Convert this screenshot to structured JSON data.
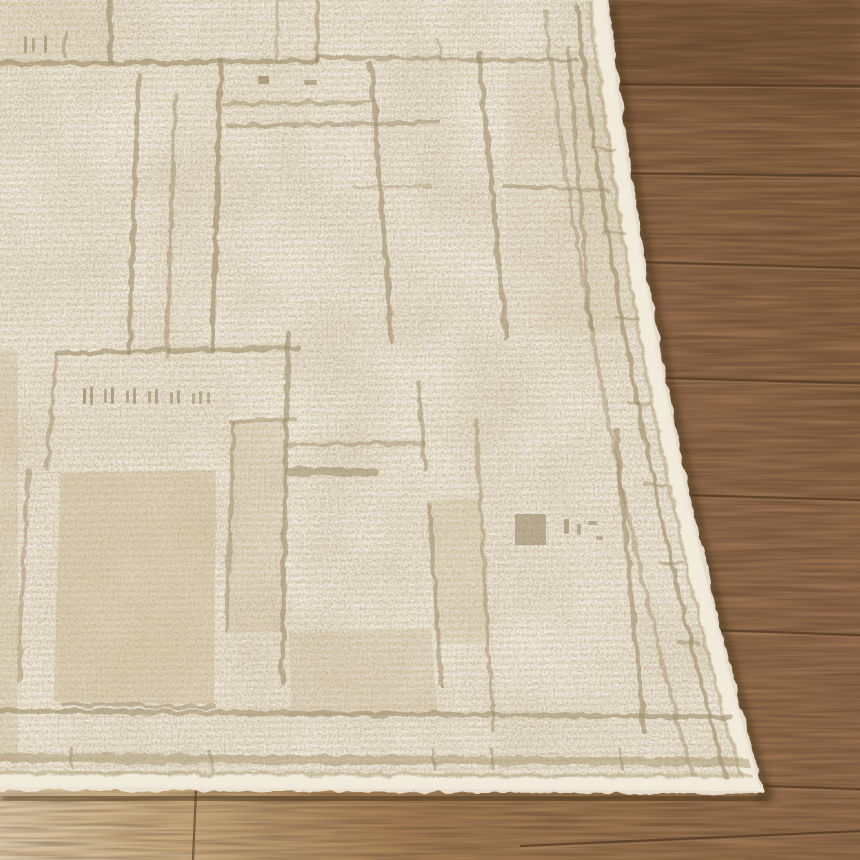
{
  "scene": {
    "description": "Close-up photo of the corner of a cream textured area rug with an abstract tan geometric grid pattern, laid diagonally on a warm oak wood plank floor",
    "rug_style": "cream bouclé pile, tonal taupe line patchwork pattern, plain cream binding edge",
    "floor_style": "oak planks, horizontal seams, pale sunlit strip at bottom-left"
  },
  "palette": {
    "rug_base": "#eae2d0",
    "rug_highlight": "#f6f1e4",
    "rug_row_shadow": "#d8ccb2",
    "line": "#9b8862",
    "line_dark": "#8d7a55",
    "block": "#c2ae87",
    "binding": "#f2ecdd",
    "groove": "#b3a37e",
    "stripe": "#a7936c",
    "wood_dark": "#7d5a3d",
    "wood_mid": "#8d6a48",
    "wood_light": "#a9835a",
    "floor_pale": "#e0cfb2",
    "seam": "#553c26",
    "seam_light": "#bb9368",
    "shadow": "#443019"
  },
  "render": {
    "rug": {
      "outline_path": "M0,0 L606,0 Q652,405 761,791 L0,787 Z",
      "corner": {
        "x": 761,
        "y": 791
      },
      "field_lines": [
        [
          0,
          64,
          318,
          61,
          5,
          0.6
        ],
        [
          318,
          57,
          577,
          61,
          4,
          0.5
        ],
        [
          225,
          104,
          373,
          102,
          4,
          0.45
        ],
        [
          228,
          126,
          438,
          123,
          4,
          0.5
        ],
        [
          352,
          187,
          432,
          186,
          3,
          0.35
        ],
        [
          505,
          186,
          607,
          191,
          4,
          0.45
        ],
        [
          56,
          353,
          298,
          348,
          5,
          0.55
        ],
        [
          230,
          421,
          296,
          419,
          4,
          0.45
        ],
        [
          288,
          445,
          424,
          443,
          4,
          0.45
        ],
        [
          290,
          471,
          376,
          473,
          9,
          0.45,
          "#8d7a55"
        ],
        [
          63,
          704,
          214,
          707,
          4,
          0.5
        ],
        [
          110,
          0,
          111,
          63,
          5,
          0.55
        ],
        [
          277,
          0,
          277,
          61,
          3,
          0.35
        ],
        [
          317,
          0,
          318,
          61,
          4,
          0.5
        ],
        [
          65,
          31,
          66,
          56,
          3,
          0.45
        ],
        [
          139,
          76,
          129,
          353,
          5,
          0.55
        ],
        [
          175,
          96,
          167,
          357,
          4,
          0.45
        ],
        [
          221,
          63,
          212,
          351,
          5,
          0.6
        ],
        [
          371,
          64,
          392,
          341,
          5,
          0.55
        ],
        [
          438,
          40,
          440,
          59,
          3,
          0.35
        ],
        [
          417,
          381,
          425,
          469,
          4,
          0.5
        ],
        [
          429,
          505,
          442,
          686,
          4,
          0.5
        ],
        [
          479,
          55,
          506,
          338,
          5,
          0.55
        ],
        [
          476,
          421,
          493,
          729,
          4,
          0.45
        ],
        [
          568,
          48,
          591,
          331,
          4,
          0.5
        ],
        [
          616,
          431,
          644,
          732,
          5,
          0.55
        ],
        [
          56,
          355,
          47,
          469,
          4,
          0.45
        ],
        [
          28,
          470,
          19,
          681,
          4,
          0.45
        ],
        [
          234,
          421,
          226,
          632,
          4,
          0.45
        ],
        [
          288,
          333,
          282,
          684,
          5,
          0.55
        ]
      ],
      "blocks": [
        {
          "p": "60,473 216,470 214,704 54,701",
          "o": 0.4
        },
        {
          "p": "231,422 287,420 283,631 226,633",
          "o": 0.28
        },
        {
          "p": "289,633 431,629 437,713 291,716",
          "o": 0.28
        },
        {
          "p": "0,0 110,0 110,63 0,64",
          "o": 0.15
        },
        {
          "p": "568,50 604,60 640,330 592,332",
          "o": 0.2
        },
        {
          "p": "426,500 478,498 491,641 437,644",
          "o": 0.25
        },
        {
          "p": "0,350 18,350 18,762 0,760",
          "o": 0.3
        },
        {
          "p": "506,56 568,48 590,330 506,336",
          "o": 0.1
        }
      ],
      "marks": [
        [
          258,
          76,
          11,
          8,
          0.6
        ],
        [
          304,
          80,
          13,
          5,
          0.5
        ],
        [
          515,
          514,
          31,
          31,
          0.5
        ],
        [
          564,
          519,
          5,
          15,
          0.55
        ],
        [
          577,
          524,
          4,
          11,
          0.5
        ],
        [
          588,
          521,
          9,
          4,
          0.5
        ],
        [
          596,
          536,
          7,
          4,
          0.45
        ],
        [
          24,
          36,
          3,
          17,
          0.5
        ],
        [
          32,
          38,
          3,
          14,
          0.45
        ],
        [
          44,
          35,
          3,
          18,
          0.5
        ],
        [
          83,
          388,
          3,
          16,
          0.6
        ],
        [
          90,
          386,
          3,
          19,
          0.55
        ],
        [
          104,
          389,
          3,
          14,
          0.5
        ],
        [
          111,
          387,
          3,
          17,
          0.6
        ],
        [
          126,
          390,
          3,
          13,
          0.5
        ],
        [
          133,
          388,
          3,
          16,
          0.55
        ],
        [
          148,
          391,
          3,
          12,
          0.5
        ],
        [
          155,
          389,
          3,
          15,
          0.55
        ],
        [
          170,
          392,
          3,
          12,
          0.5
        ],
        [
          177,
          390,
          3,
          14,
          0.5
        ],
        [
          192,
          393,
          3,
          11,
          0.45
        ],
        [
          199,
          391,
          3,
          13,
          0.5
        ],
        [
          207,
          392,
          3,
          12,
          0.45
        ]
      ],
      "border_paths": [
        {
          "d": "M599,1 Q645,406 754,792",
          "w": 13,
          "c": "#f2ecdd",
          "o": 0.95
        },
        {
          "d": "M590,3 Q636,408 745,794",
          "w": 3,
          "c": "#b3a37e",
          "o": 0.5
        },
        {
          "d": "M577,6 Q622,411 732,797",
          "w": 4,
          "c": "#9b8862",
          "o": 0.6
        },
        {
          "d": "M545,12 Q591,417 700,803",
          "w": 4,
          "c": "#9b8862",
          "o": 0.4
        },
        {
          "d": "M0,781 L757,785",
          "w": 12,
          "c": "#f2ecdd",
          "o": 0.95
        },
        {
          "d": "M0,772 L752,776",
          "w": 3,
          "c": "#b3a37e",
          "o": 0.5
        },
        {
          "d": "M0,758 L748,762",
          "w": 9,
          "c": "#a7936c",
          "o": 0.5
        },
        {
          "d": "M0,711 L730,717",
          "w": 5,
          "c": "#9b8862",
          "o": 0.55
        }
      ],
      "fuzz_paths": [
        {
          "d": "M606,0 Q652,405 761,791",
          "w": 6,
          "c": "#f0e9da",
          "o": 0.9
        },
        {
          "d": "M0,787 L761,791",
          "w": 6,
          "c": "#f0e9da",
          "o": 0.9
        }
      ],
      "border_dashes": [
        [
          593,
          148,
          615,
          150
        ],
        [
          603,
          232,
          625,
          234
        ],
        [
          615,
          318,
          637,
          320
        ],
        [
          628,
          402,
          650,
          404
        ],
        [
          644,
          484,
          666,
          486
        ],
        [
          660,
          562,
          682,
          564
        ],
        [
          678,
          642,
          700,
          644
        ],
        [
          70,
          748,
          72,
          768
        ],
        [
          210,
          750,
          212,
          770
        ],
        [
          432,
          748,
          434,
          768
        ],
        [
          492,
          749,
          494,
          769
        ],
        [
          620,
          750,
          622,
          770
        ]
      ]
    },
    "floor": {
      "plank_seams": [
        [
          606,
          84,
          860,
          86
        ],
        [
          622,
          173,
          860,
          176
        ],
        [
          641,
          262,
          860,
          268
        ],
        [
          663,
          378,
          860,
          383
        ],
        [
          688,
          495,
          860,
          500
        ],
        [
          714,
          630,
          860,
          635
        ],
        [
          765,
          786,
          860,
          789
        ],
        [
          520,
          846,
          860,
          831
        ],
        [
          196,
          791,
          193,
          860
        ]
      ]
    }
  }
}
